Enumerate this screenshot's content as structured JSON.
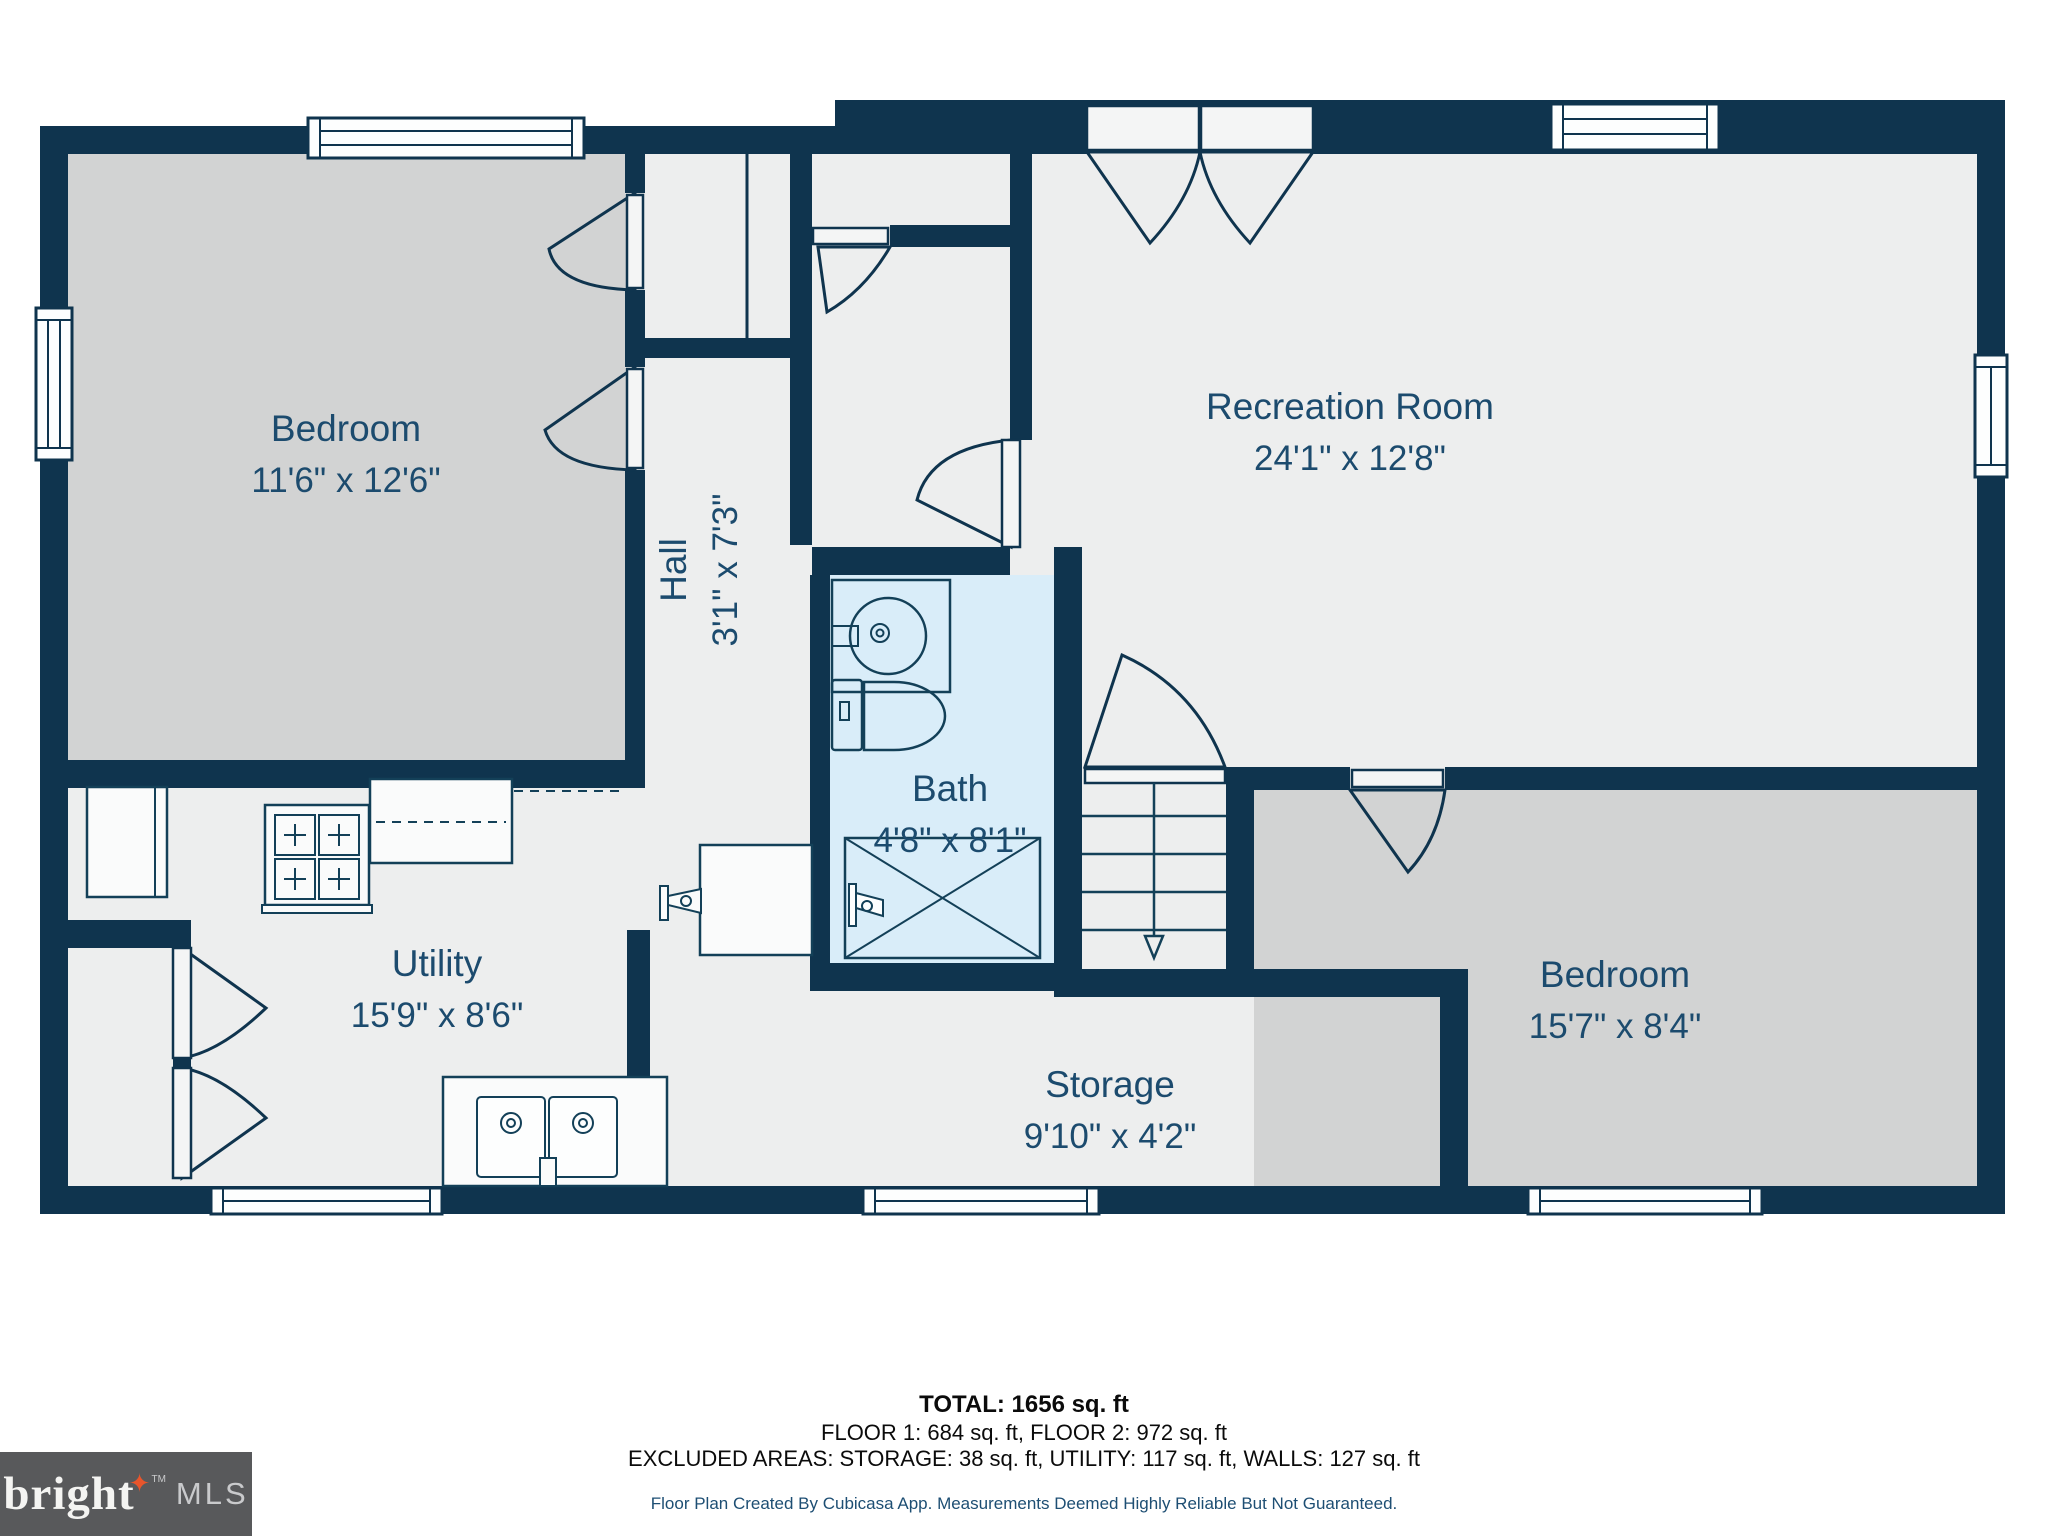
{
  "plan": {
    "rooms": [
      {
        "name": "Bedroom",
        "dims": "11'6\" x 12'6\""
      },
      {
        "name": "Recreation Room",
        "dims": "24'1\" x 12'8\""
      },
      {
        "name": "Hall",
        "dims": "3'1\" x 7'3\""
      },
      {
        "name": "Bath",
        "dims": "4'8\" x 8'1\""
      },
      {
        "name": "Utility",
        "dims": "15'9\" x 8'6\""
      },
      {
        "name": "Storage",
        "dims": "9'10\" x 4'2\""
      },
      {
        "name": "Bedroom",
        "dims": "15'7\" x 8'4\""
      }
    ]
  },
  "footer": {
    "total": "TOTAL: 1656 sq. ft",
    "floors": "FLOOR 1: 684 sq. ft, FLOOR 2: 972 sq. ft",
    "excluded": "EXCLUDED AREAS: STORAGE: 38 sq. ft, UTILITY: 117 sq. ft, WALLS: 127 sq. ft",
    "disclaimer": "Floor Plan Created By Cubicasa App. Measurements Deemed Highly Reliable But Not Guaranteed."
  },
  "logo": {
    "brand": "bright",
    "star": "✦",
    "tm": "TM",
    "suffix": "MLS"
  },
  "colors": {
    "wall": "#0F344E",
    "floor": "#EDEEEE",
    "bedroom_fill": "#D2D3D3",
    "bath_fill": "#D9EDF9",
    "label": "#1C4B6E",
    "logo_bg": "#58595B",
    "logo_star": "#E8552C"
  }
}
